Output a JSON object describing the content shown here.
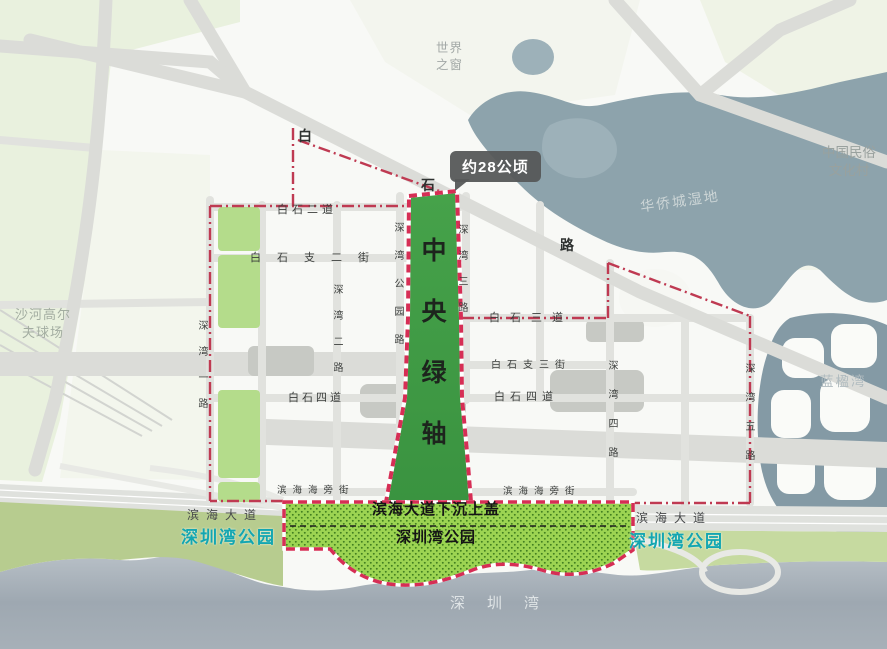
{
  "colors": {
    "axis_green": "#3f9b44",
    "strip_green": "#9cd452",
    "light_strip_green": "#b4dc8b",
    "boundary_red": "#bf3a52",
    "axis_border_red": "#d62e55",
    "park_label_teal": "#13a6b1",
    "wetland_water": "#8da3ac",
    "sea_water": "#9aa5ae"
  },
  "callout": {
    "area": "约28公顷"
  },
  "axis": {
    "label": "中央绿轴"
  },
  "strip": {
    "line1": "滨海大道下沉上盖",
    "line2": "深圳湾公园"
  },
  "parks": {
    "left": "深圳湾公园",
    "right": "深圳湾公园"
  },
  "landmarks": {
    "world_window": "世界\n之窗",
    "folk_culture_village": "中国民俗\n文化村",
    "oct_wetland": "华侨城湿地",
    "shahe_golf": "沙河高尔\n夫球场",
    "blue_bay": "蓝楹湾",
    "shenzhen_bay": "深圳湾"
  },
  "roads": {
    "baishi_char_1": "白",
    "baishi_char_2": "石",
    "baishi_char_3": "路",
    "baishi_2dao": "白石二道",
    "baishi_zhi2": "白石支二街",
    "baishi_3dao": "白石三道",
    "baishi_zhi3": "白石支三街",
    "baishi_4dao_left": "白石四道",
    "baishi_4dao_right": "白石四道",
    "shenwan_1": "深湾一路",
    "shenwan_2": "深湾二路",
    "shenwan_3": "深湾三路",
    "shenwan_4": "深湾四路",
    "shenwan_5": "深湾五路",
    "shenwan_park": "深湾公园路",
    "haipang_left": "滨海海旁街",
    "haipang_right": "滨海海旁街",
    "binhai_left": "滨海大道",
    "binhai_right": "滨海大道"
  }
}
